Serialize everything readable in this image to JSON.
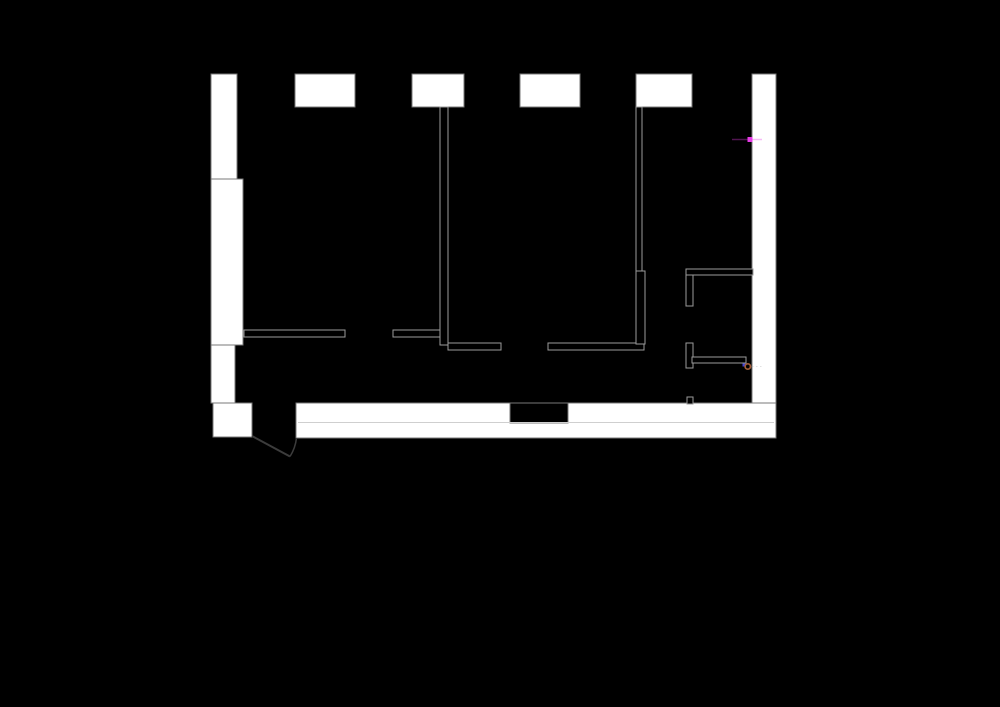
{
  "scene": {
    "width": 1000,
    "height": 707,
    "background": "#000000",
    "description": "black CAD viewport showing an apartment floor plan with white poche walls"
  },
  "palette": {
    "background": "#000000",
    "wall_fill": "#ffffff",
    "wall_outline": "#787878",
    "thin_wall_fill": "#000000",
    "thin_wall_stroke": "#9b9b9b",
    "seam_line": "#cfcfcf",
    "door_line": "#3c3c3c",
    "marker_magenta": "#e63ce6",
    "marker_magenta_glow": "rgba(232,60,232,0.35)",
    "marker_blue": "#4343d2",
    "marker_circle_ring": "#a15c38",
    "marker_faint_gray": "rgba(170,170,170,0.35)"
  },
  "floor_plan": {
    "bounds": {
      "x": 211,
      "y": 73,
      "w": 565,
      "h": 386
    },
    "shapes": [
      {
        "type": "rect",
        "name": "left-wall-upper",
        "x": 211,
        "y": 74,
        "w": 26,
        "h": 105,
        "fill": "wall_fill",
        "stroke": "wall_outline",
        "sw": 1
      },
      {
        "type": "rect",
        "name": "left-wall-pilaster",
        "x": 211,
        "y": 179,
        "w": 32,
        "h": 166,
        "fill": "wall_fill",
        "stroke": "wall_outline",
        "sw": 1
      },
      {
        "type": "rect",
        "name": "left-wall-lower",
        "x": 211,
        "y": 345,
        "w": 24,
        "h": 58,
        "fill": "wall_fill",
        "stroke": "wall_outline",
        "sw": 1
      },
      {
        "type": "rect",
        "name": "top-wall-pier-1",
        "x": 295,
        "y": 74,
        "w": 60,
        "h": 33,
        "fill": "wall_fill",
        "stroke": "wall_outline",
        "sw": 1
      },
      {
        "type": "rect",
        "name": "top-wall-pier-2",
        "x": 412,
        "y": 74,
        "w": 52,
        "h": 33,
        "fill": "wall_fill",
        "stroke": "wall_outline",
        "sw": 1
      },
      {
        "type": "rect",
        "name": "top-wall-pier-3",
        "x": 520,
        "y": 74,
        "w": 60,
        "h": 33,
        "fill": "wall_fill",
        "stroke": "wall_outline",
        "sw": 1
      },
      {
        "type": "rect",
        "name": "top-wall-pier-4",
        "x": 636,
        "y": 74,
        "w": 56,
        "h": 33,
        "fill": "wall_fill",
        "stroke": "wall_outline",
        "sw": 1
      },
      {
        "type": "rect",
        "name": "right-wall",
        "x": 752,
        "y": 74,
        "w": 24,
        "h": 364,
        "fill": "wall_fill",
        "stroke": "wall_outline",
        "sw": 1
      },
      {
        "type": "rect",
        "name": "bottom-wall-left-stub",
        "x": 213,
        "y": 403,
        "w": 39,
        "h": 34,
        "fill": "wall_fill",
        "stroke": "wall_outline",
        "sw": 1
      },
      {
        "type": "rect",
        "name": "bottom-wall-main",
        "x": 296,
        "y": 403,
        "w": 480,
        "h": 35,
        "fill": "wall_fill",
        "stroke": "wall_outline",
        "sw": 1
      },
      {
        "type": "rect",
        "name": "bottom-wall-opening-notch",
        "x": 510,
        "y": 403,
        "w": 58,
        "h": 20,
        "fill": "background",
        "stroke": "wall_outline",
        "sw": 1
      },
      {
        "type": "line",
        "name": "bottom-wall-seam-line",
        "x1": 298,
        "y1": 422.5,
        "x2": 774,
        "y2": 422.5,
        "stroke": "seam_line",
        "sw": 1
      },
      {
        "type": "rect",
        "name": "interior-wall-left-a",
        "x": 244,
        "y": 330,
        "w": 101,
        "h": 7,
        "fill": "thin_wall_fill",
        "stroke": "thin_wall_stroke",
        "sw": 1
      },
      {
        "type": "rect",
        "name": "interior-wall-left-b",
        "x": 393,
        "y": 330,
        "w": 48,
        "h": 7,
        "fill": "thin_wall_fill",
        "stroke": "thin_wall_stroke",
        "sw": 1
      },
      {
        "type": "rect",
        "name": "interior-wall-vertical-1",
        "x": 440,
        "y": 107,
        "w": 8,
        "h": 238,
        "fill": "thin_wall_fill",
        "stroke": "thin_wall_stroke",
        "sw": 1
      },
      {
        "type": "rect",
        "name": "interior-wall-mid-a",
        "x": 448,
        "y": 343,
        "w": 53,
        "h": 7,
        "fill": "thin_wall_fill",
        "stroke": "thin_wall_stroke",
        "sw": 1
      },
      {
        "type": "rect",
        "name": "interior-wall-mid-b",
        "x": 548,
        "y": 343,
        "w": 96,
        "h": 7,
        "fill": "thin_wall_fill",
        "stroke": "thin_wall_stroke",
        "sw": 1
      },
      {
        "type": "rect",
        "name": "interior-wall-vertical-2-upper",
        "x": 636,
        "y": 107,
        "w": 6,
        "h": 164,
        "fill": "thin_wall_fill",
        "stroke": "thin_wall_stroke",
        "sw": 1
      },
      {
        "type": "rect",
        "name": "interior-wall-vertical-2-lower",
        "x": 636,
        "y": 271,
        "w": 9,
        "h": 73,
        "fill": "thin_wall_fill",
        "stroke": "thin_wall_stroke",
        "sw": 1
      },
      {
        "type": "rect",
        "name": "bathroom-top-wall",
        "x": 686,
        "y": 269,
        "w": 67,
        "h": 6,
        "fill": "thin_wall_fill",
        "stroke": "thin_wall_stroke",
        "sw": 1
      },
      {
        "type": "rect",
        "name": "bathroom-stub-upper",
        "x": 686,
        "y": 275,
        "w": 7,
        "h": 31,
        "fill": "thin_wall_fill",
        "stroke": "thin_wall_stroke",
        "sw": 1
      },
      {
        "type": "rect",
        "name": "bathroom-stub-lower",
        "x": 686,
        "y": 343,
        "w": 7,
        "h": 25,
        "fill": "thin_wall_fill",
        "stroke": "thin_wall_stroke",
        "sw": 1
      },
      {
        "type": "rect",
        "name": "bathroom-inner-wall",
        "x": 692,
        "y": 357,
        "w": 54,
        "h": 6,
        "fill": "thin_wall_fill",
        "stroke": "thin_wall_stroke",
        "sw": 1
      },
      {
        "type": "rect",
        "name": "bathroom-stub-bottom",
        "x": 687,
        "y": 397,
        "w": 6,
        "h": 7,
        "fill": "thin_wall_fill",
        "stroke": "thin_wall_stroke",
        "sw": 1
      },
      {
        "type": "line",
        "name": "entry-door-leaf",
        "x1": 252,
        "y1": 436,
        "x2": 290,
        "y2": 456.5,
        "stroke": "door_line",
        "sw": 2
      },
      {
        "type": "path",
        "name": "entry-door-swing-arc",
        "d": "M 290 456.5 A 44 44 0 0 0 296.5 438",
        "fill": "none",
        "stroke": "door_line",
        "sw": 1.5
      },
      {
        "type": "line",
        "name": "magenta-snap-glow-line",
        "x1": 732,
        "y1": 139.5,
        "x2": 762,
        "y2": 139.5,
        "stroke": "marker_magenta_glow",
        "sw": 1.5
      },
      {
        "type": "rect",
        "name": "magenta-vertex-marker",
        "x": 747.5,
        "y": 137,
        "w": 5,
        "h": 5,
        "fill": "marker_magenta"
      },
      {
        "type": "rect",
        "name": "blue-endpoint-marker",
        "x": 742.5,
        "y": 363.5,
        "w": 3,
        "h": 3,
        "fill": "marker_blue"
      },
      {
        "type": "circle",
        "name": "circle-node-marker",
        "cx": 747.8,
        "cy": 366.5,
        "r": 2.7,
        "fill": "none",
        "stroke": "marker_circle_ring",
        "sw": 1.7
      },
      {
        "type": "line",
        "name": "faint-dotted-trace",
        "x1": 752,
        "y1": 366.5,
        "x2": 763,
        "y2": 366.5,
        "stroke": "marker_faint_gray",
        "sw": 1,
        "dash": "1.5,2.5"
      }
    ]
  }
}
